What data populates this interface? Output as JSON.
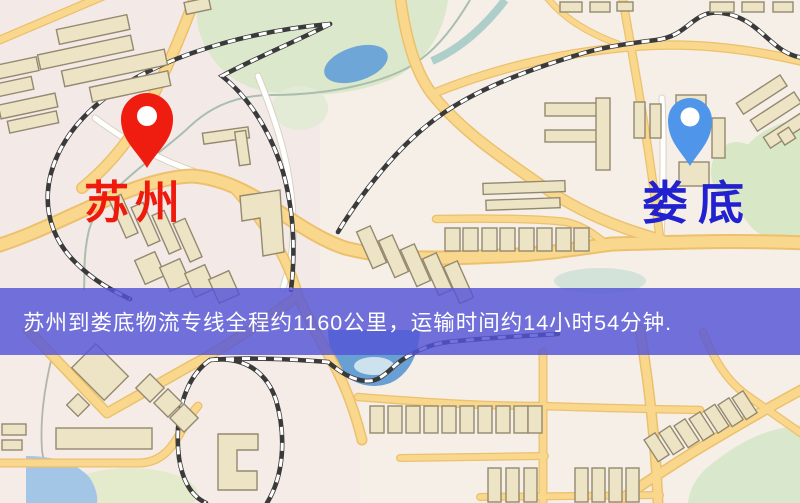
{
  "map": {
    "origin": {
      "label": "苏州",
      "pin_color": "#ef1d10",
      "label_color": "#ee1a0d"
    },
    "destination": {
      "label": "娄底",
      "pin_color": "#4f96ea",
      "label_color": "#2121cf"
    }
  },
  "banner": {
    "text": "苏州到娄底物流专线全程约1160公里，运输时间约14小时54分钟.",
    "background_color": "#5454d8",
    "text_color": "#ffffff"
  },
  "colors": {
    "map_background": "#f5efe8",
    "road_main": "#f9d88d",
    "road_casing": "#ecc06c",
    "park_green": "#dce8cb",
    "water_blue": "#6ea6d8",
    "building_fill": "#ede4c6",
    "railway_dark": "#3a3a3a"
  }
}
